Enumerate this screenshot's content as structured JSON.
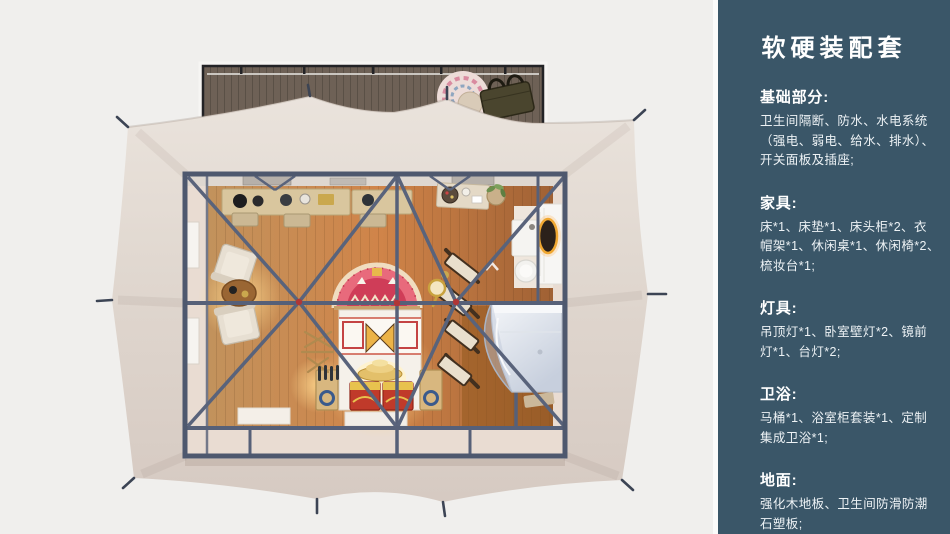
{
  "panel": {
    "title": "软硬装配套",
    "background_color": "#3a5668",
    "text_color": "#ffffff",
    "sections": [
      {
        "heading": "基础部分:",
        "lines": [
          "卫生间隔断、防水、水电系统",
          "（强电、弱电、给水、排水）、",
          "开关面板及插座;"
        ]
      },
      {
        "heading": "家具:",
        "lines": [
          "床*1、床垫*1、床头柜*2、衣",
          "帽架*1、休闲桌*1、休闲椅*2、",
          "梳妆台*1;"
        ]
      },
      {
        "heading": "灯具:",
        "lines": [
          "吊顶灯*1、卧室壁灯*2、镜前",
          "灯*1、台灯*2;"
        ]
      },
      {
        "heading": "卫浴:",
        "lines": [
          "马桶*1、浴室柜套装*1、定制",
          "集成卫浴*1;"
        ]
      },
      {
        "heading": "地面:",
        "lines": [
          "强化木地板、卫生间防滑防潮",
          "石塑板;"
        ]
      }
    ]
  },
  "scene": {
    "colors": {
      "page_background": "#f0efed",
      "tent_fabric": "#e0d7cf",
      "deck_wood": "#6e6156",
      "steel_frame": "#566078",
      "floor_wood_warm": "#cf8149",
      "headboard_rug_red": "#d84f63",
      "shower_glass": "#ccd4dd",
      "lamp_glow": "#ffd98f",
      "node_accent_red": "#b03636"
    }
  }
}
